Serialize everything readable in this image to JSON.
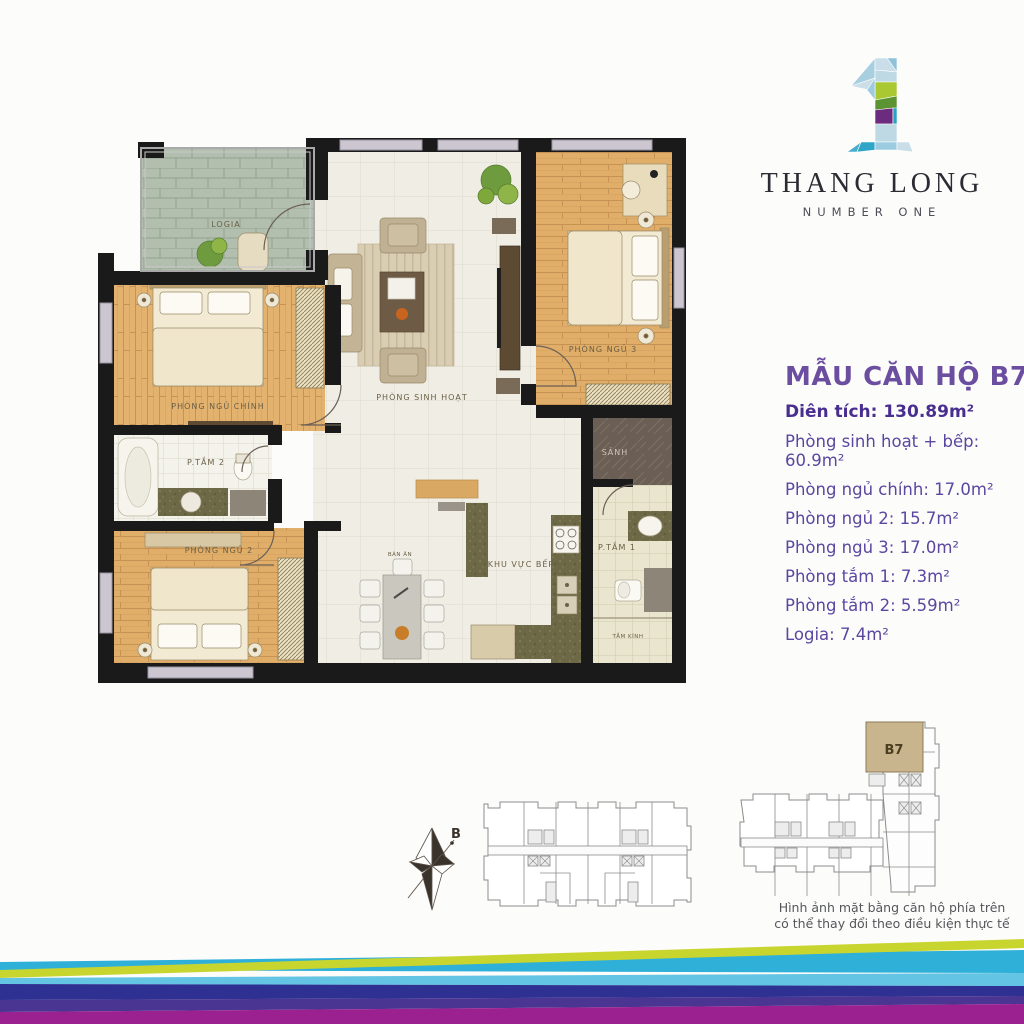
{
  "brand": {
    "name": "THANG LONG",
    "tagline": "NUMBER ONE"
  },
  "info": {
    "title": "MẪU CĂN HỘ B7",
    "area_line": "Diên tích: 130.89m²",
    "lines": [
      "Phòng sinh hoạt + bếp: 60.9m²",
      "Phòng ngủ chính: 17.0m²",
      "Phòng ngủ 2: 15.7m²",
      "Phòng ngủ 3: 17.0m²",
      "Phòng tắm 1: 7.3m²",
      "Phòng tắm 2: 5.59m²",
      "Logia: 7.4m²"
    ]
  },
  "plan": {
    "rooms": {
      "logia": "LOGIA",
      "master": "PHÒNG NGỦ CHÍNH",
      "bath2": "P.TẮM 2",
      "bed2": "PHÒNG NGỦ 2",
      "living": "PHÒNG SINH HOẠT",
      "bed3": "PHÒNG NGỦ 3",
      "hall": "SẢNH",
      "bath1": "P.TẮM 1",
      "kitchen": "KHU VỰC BẾP",
      "dining": "BÀN ĂN",
      "shower": "TẮM KÍNH"
    }
  },
  "keyplan": {
    "unit_label": "B7",
    "compass_label": "B"
  },
  "disclaimer": {
    "line1": "Hình ảnh mặt bằng căn hộ phía trên",
    "line2": "có thể thay đổi theo điều kiện thực tế"
  },
  "colors": {
    "accent_purple": "#5B47A0",
    "title_purple": "#6C4EA1",
    "area_purple": "#4A2E8F",
    "wall_black": "#1A1A1A",
    "wood_floor": "#E3B26E",
    "b7_highlight": "#C8B58E",
    "wave_lime": "#C9D52F",
    "wave_cyan": "#2FB0D8",
    "wave_sky": "#63C5E3",
    "wave_indigo": "#2E3192",
    "wave_violet": "#4B3592",
    "wave_magenta": "#9B2190"
  }
}
